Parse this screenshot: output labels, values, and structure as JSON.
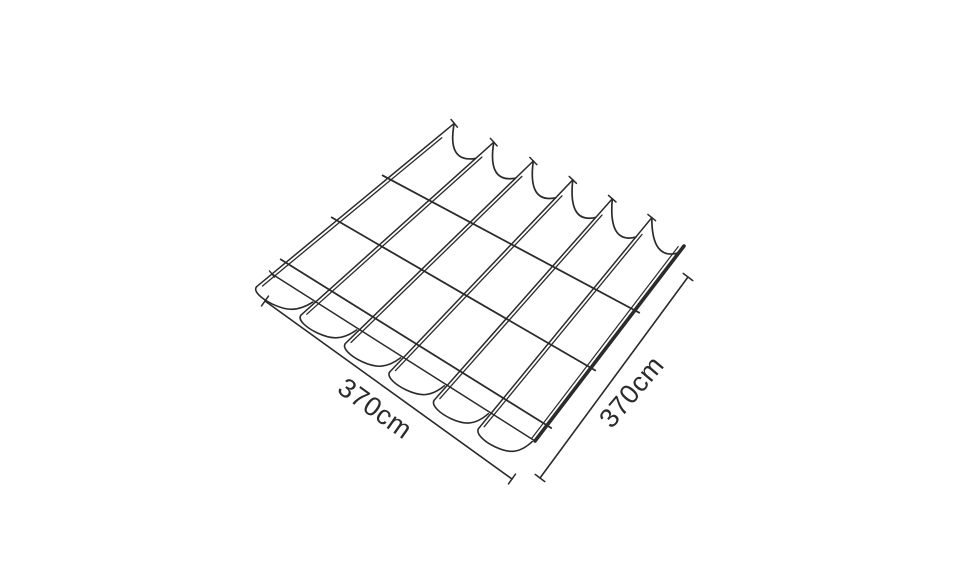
{
  "diagram": {
    "background_color": "#ffffff",
    "line_color": "#2b2b2b",
    "canopy": {
      "strip_count": 6,
      "cross_bar_count": 3
    },
    "dimensions": {
      "width_label": "370cm",
      "depth_label": "370cm"
    }
  }
}
